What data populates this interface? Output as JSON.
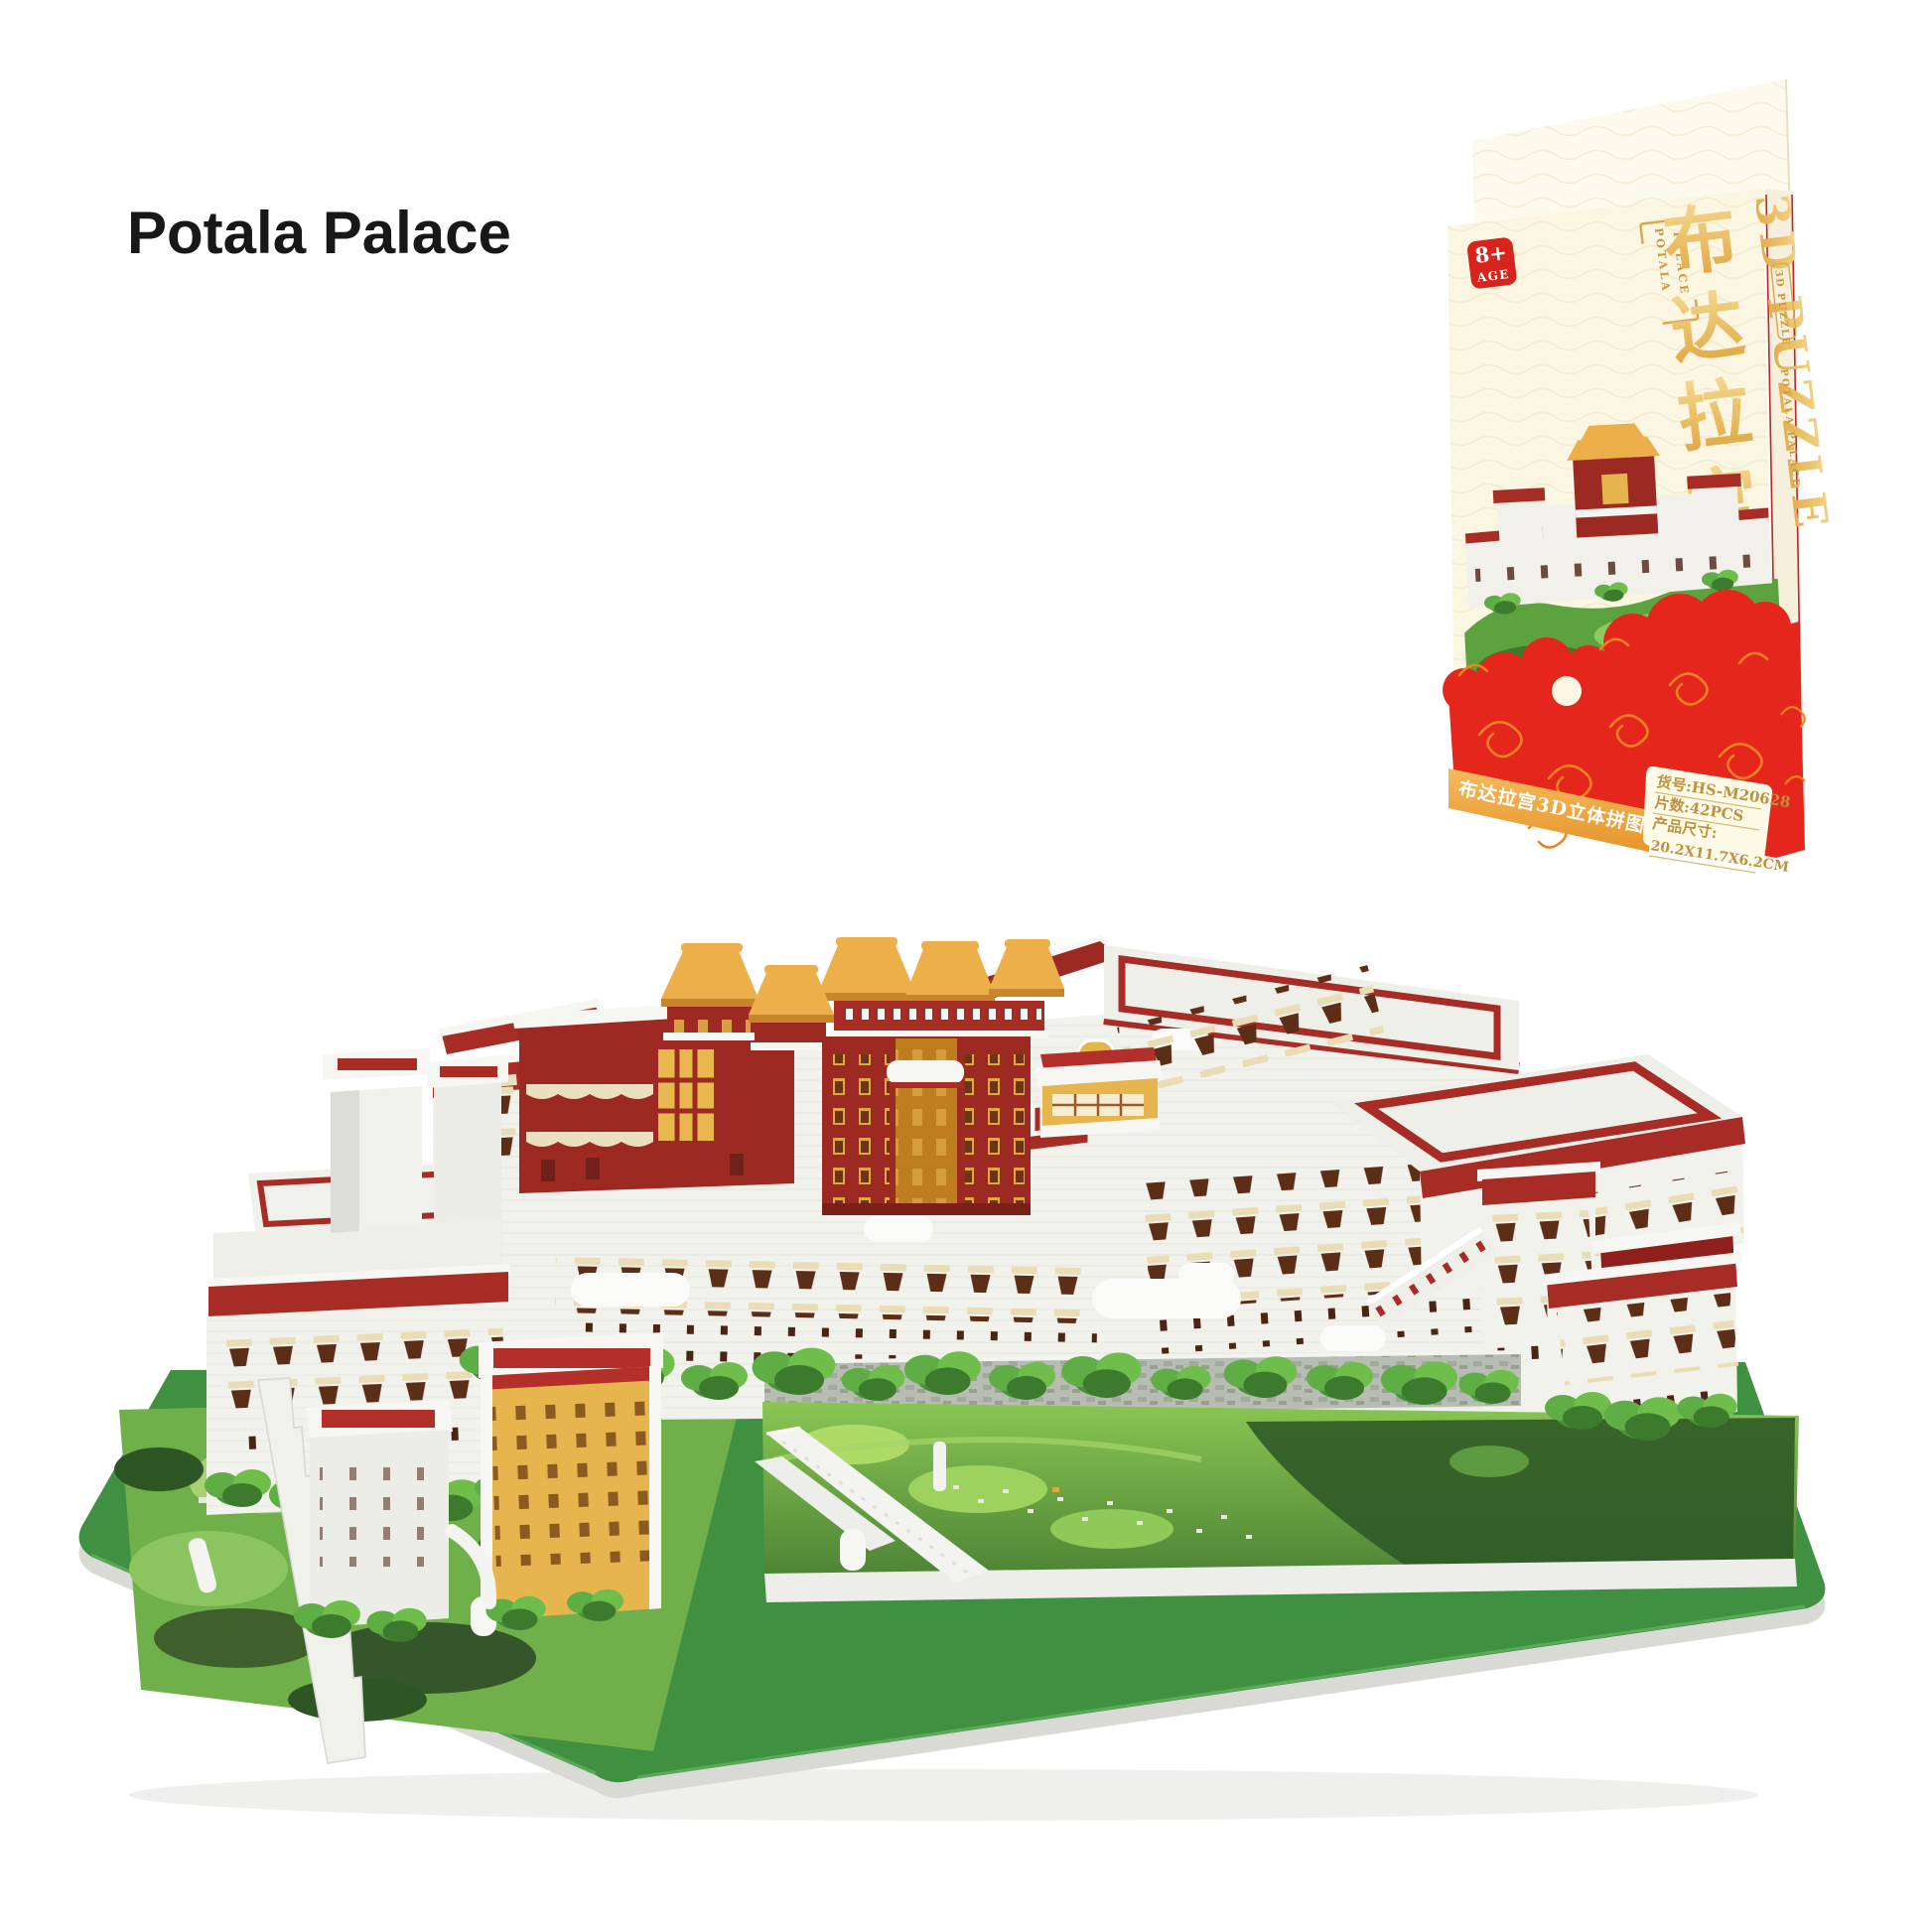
{
  "page": {
    "title": "Potala Palace",
    "background": "#FFFFFF"
  },
  "box": {
    "age_badge": {
      "number": "8+",
      "label": "AGE"
    },
    "front": {
      "series_frame": {
        "line1": "POTALA",
        "line2": "PALACE"
      },
      "title_cn_chars": [
        "布",
        "达",
        "拉",
        "宫"
      ],
      "title_en": "3D PUZZLE",
      "banner_text": "布达拉宫3D立体拼图",
      "info": {
        "item_no": "货号:HS-M20628",
        "pieces": "片数:42PCS",
        "size_label": "产品尺寸:",
        "size_value": "20.2X11.7X6.2CM"
      }
    },
    "spine": {
      "badge_text": "3D PUZZLE",
      "title_text": "POTALA PALACE"
    },
    "colors": {
      "cream": "#FAF6E2",
      "gold": "#E2B25C",
      "deep_gold": "#C0933D",
      "cloud_red": "#E5261C",
      "swirl_orange": "#F08223",
      "banner_gold": "#EFA93F",
      "badge_red": "#D7251D"
    }
  },
  "model": {
    "colors": {
      "palace_red": "#9C2A22",
      "trim_red": "#A72C25",
      "deck_red": "#B3302A",
      "roof_gold": "#ECAF4A",
      "wall_white": "#F2F2ED",
      "building_yellow": "#E7B54E",
      "base_green": "#3F9040",
      "terrain_green": "#6FB04A",
      "window_brown": "#5C2E18"
    }
  }
}
